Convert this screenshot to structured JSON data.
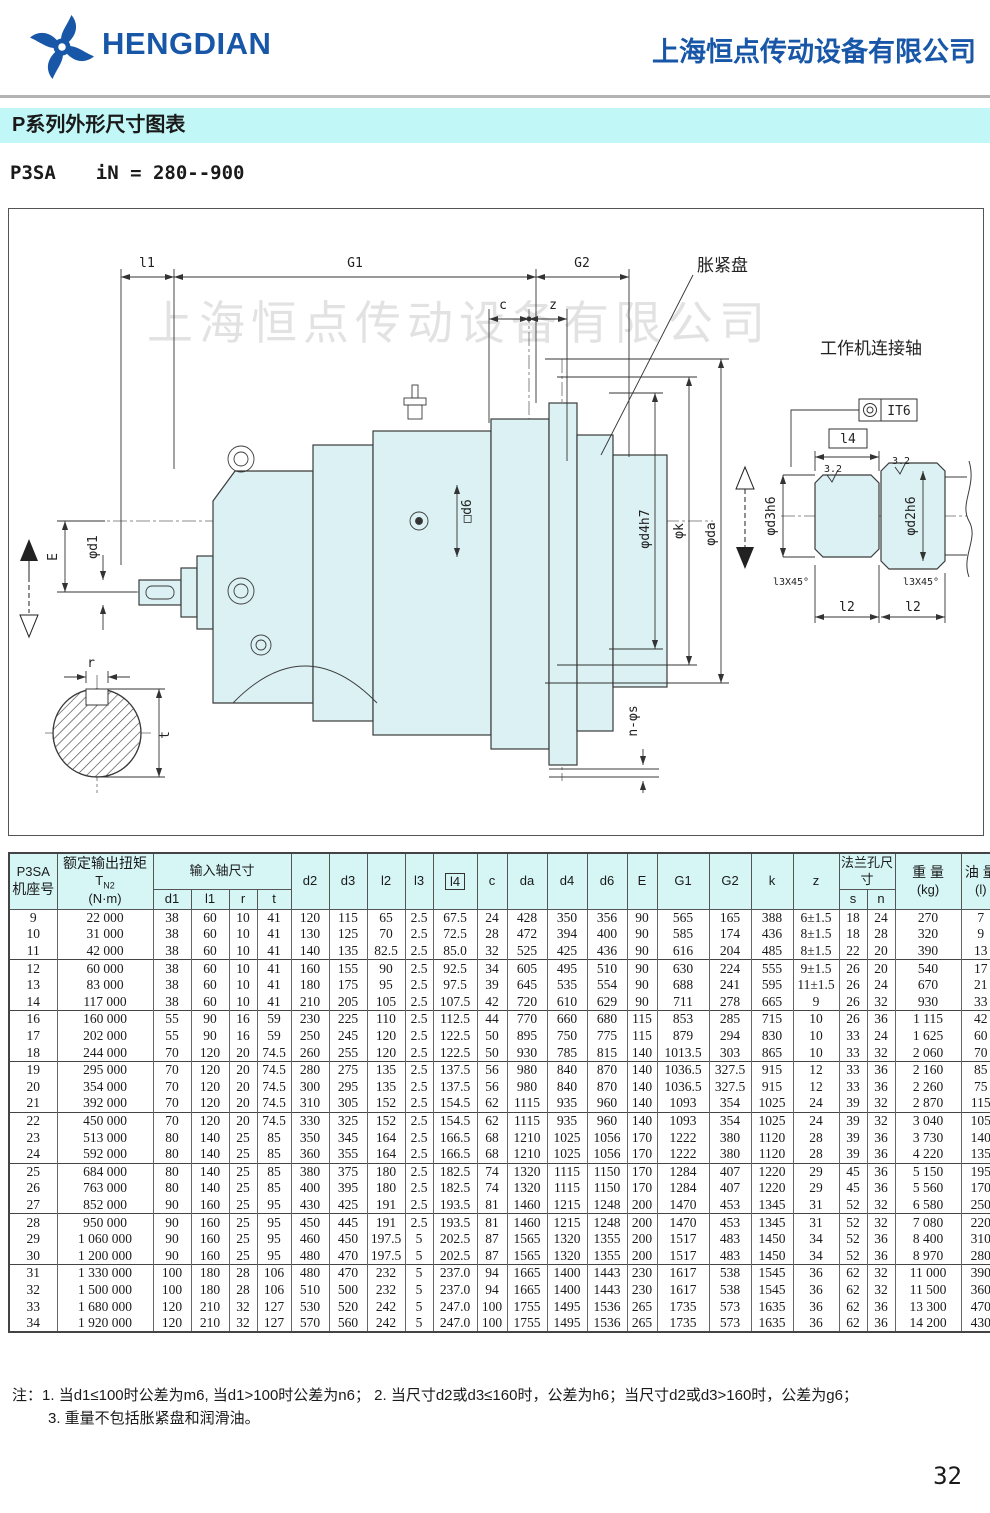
{
  "header": {
    "logo_text": "HENGDIAN",
    "company_name": "上海恒点传动设备有限公司"
  },
  "title_bar": "P系列外形尺寸图表",
  "subtitle": {
    "model": "P3SA",
    "ratio": "iN = 280--900"
  },
  "drawing": {
    "watermark": "上海恒点传动设备有限公司",
    "labels": {
      "l1": "l1",
      "g1": "G1",
      "g2": "G2",
      "c": "c",
      "z": "z",
      "shrink_disk": "胀紧盘",
      "work_shaft": "工作机连接轴",
      "it6": "IT6",
      "l4": "l4",
      "rough_left": "3.2",
      "rough_right": "3.2",
      "d3": "φd3h6",
      "d2": "φd2h6",
      "d4": "φd4h7",
      "k": "φk",
      "da": "φda",
      "d6": "□d6",
      "d1": "φd1",
      "e": "E",
      "chamfer_left": "l3X45°",
      "chamfer_right": "l3X45°",
      "l2_left": "l2",
      "l2_right": "l2",
      "ns": "n-φs",
      "r": "r",
      "t": "t"
    }
  },
  "table": {
    "headers": {
      "col1_line1": "P3SA",
      "col1_line2": "机座号",
      "torque_line1": "额定输出扭矩",
      "torque_t": "T",
      "torque_sub": "N2",
      "torque_unit": "(N·m)",
      "input_group": "输入轴尺寸",
      "sub": [
        "d1",
        "l1",
        "r",
        "t"
      ],
      "singles": [
        "d2",
        "d3",
        "l2",
        "l3",
        "l4",
        "c",
        "da",
        "d4",
        "d6",
        "E",
        "G1",
        "G2",
        "k",
        "z"
      ],
      "flange_group": "法兰孔尺寸",
      "flange_sub": [
        "s",
        "n"
      ],
      "weight_line1": "重 量",
      "weight_line2": "(kg)",
      "oil_line1": "油 量",
      "oil_line2": "(l)"
    },
    "groups": [
      [
        [
          "9",
          "22 000",
          "38",
          "60",
          "10",
          "41",
          "120",
          "115",
          "65",
          "2.5",
          "67.5",
          "24",
          "428",
          "350",
          "356",
          "90",
          "565",
          "165",
          "388",
          "6±1.5",
          "18",
          "24",
          "270",
          "7"
        ],
        [
          "10",
          "31 000",
          "38",
          "60",
          "10",
          "41",
          "130",
          "125",
          "70",
          "2.5",
          "72.5",
          "28",
          "472",
          "394",
          "400",
          "90",
          "585",
          "174",
          "436",
          "8±1.5",
          "18",
          "28",
          "320",
          "9"
        ],
        [
          "11",
          "42 000",
          "38",
          "60",
          "10",
          "41",
          "140",
          "135",
          "82.5",
          "2.5",
          "85.0",
          "32",
          "525",
          "425",
          "436",
          "90",
          "616",
          "204",
          "485",
          "8±1.5",
          "22",
          "20",
          "390",
          "13"
        ]
      ],
      [
        [
          "12",
          "60 000",
          "38",
          "60",
          "10",
          "41",
          "160",
          "155",
          "90",
          "2.5",
          "92.5",
          "34",
          "605",
          "495",
          "510",
          "90",
          "630",
          "224",
          "555",
          "9±1.5",
          "26",
          "20",
          "540",
          "17"
        ],
        [
          "13",
          "83 000",
          "38",
          "60",
          "10",
          "41",
          "180",
          "175",
          "95",
          "2.5",
          "97.5",
          "39",
          "645",
          "535",
          "554",
          "90",
          "688",
          "241",
          "595",
          "11±1.5",
          "26",
          "24",
          "670",
          "21"
        ],
        [
          "14",
          "117 000",
          "38",
          "60",
          "10",
          "41",
          "210",
          "205",
          "105",
          "2.5",
          "107.5",
          "42",
          "720",
          "610",
          "629",
          "90",
          "711",
          "278",
          "665",
          "9",
          "26",
          "32",
          "930",
          "33"
        ]
      ],
      [
        [
          "16",
          "160 000",
          "55",
          "90",
          "16",
          "59",
          "230",
          "225",
          "110",
          "2.5",
          "112.5",
          "44",
          "770",
          "660",
          "680",
          "115",
          "853",
          "285",
          "715",
          "10",
          "26",
          "36",
          "1 115",
          "42"
        ],
        [
          "17",
          "202 000",
          "55",
          "90",
          "16",
          "59",
          "250",
          "245",
          "120",
          "2.5",
          "122.5",
          "50",
          "895",
          "750",
          "775",
          "115",
          "879",
          "294",
          "830",
          "10",
          "33",
          "24",
          "1 625",
          "60"
        ],
        [
          "18",
          "244 000",
          "70",
          "120",
          "20",
          "74.5",
          "260",
          "255",
          "120",
          "2.5",
          "122.5",
          "50",
          "930",
          "785",
          "815",
          "140",
          "1013.5",
          "303",
          "865",
          "10",
          "33",
          "32",
          "2 060",
          "70"
        ]
      ],
      [
        [
          "19",
          "295 000",
          "70",
          "120",
          "20",
          "74.5",
          "280",
          "275",
          "135",
          "2.5",
          "137.5",
          "56",
          "980",
          "840",
          "870",
          "140",
          "1036.5",
          "327.5",
          "915",
          "12",
          "33",
          "36",
          "2 160",
          "85"
        ],
        [
          "20",
          "354 000",
          "70",
          "120",
          "20",
          "74.5",
          "300",
          "295",
          "135",
          "2.5",
          "137.5",
          "56",
          "980",
          "840",
          "870",
          "140",
          "1036.5",
          "327.5",
          "915",
          "12",
          "33",
          "36",
          "2 260",
          "75"
        ],
        [
          "21",
          "392 000",
          "70",
          "120",
          "20",
          "74.5",
          "310",
          "305",
          "152",
          "2.5",
          "154.5",
          "62",
          "1115",
          "935",
          "960",
          "140",
          "1093",
          "354",
          "1025",
          "24",
          "39",
          "32",
          "2 870",
          "115"
        ]
      ],
      [
        [
          "22",
          "450 000",
          "70",
          "120",
          "20",
          "74.5",
          "330",
          "325",
          "152",
          "2.5",
          "154.5",
          "62",
          "1115",
          "935",
          "960",
          "140",
          "1093",
          "354",
          "1025",
          "24",
          "39",
          "32",
          "3 040",
          "105"
        ],
        [
          "23",
          "513 000",
          "80",
          "140",
          "25",
          "85",
          "350",
          "345",
          "164",
          "2.5",
          "166.5",
          "68",
          "1210",
          "1025",
          "1056",
          "170",
          "1222",
          "380",
          "1120",
          "28",
          "39",
          "36",
          "3 730",
          "140"
        ],
        [
          "24",
          "592 000",
          "80",
          "140",
          "25",
          "85",
          "360",
          "355",
          "164",
          "2.5",
          "166.5",
          "68",
          "1210",
          "1025",
          "1056",
          "170",
          "1222",
          "380",
          "1120",
          "28",
          "39",
          "36",
          "4 220",
          "135"
        ]
      ],
      [
        [
          "25",
          "684 000",
          "80",
          "140",
          "25",
          "85",
          "380",
          "375",
          "180",
          "2.5",
          "182.5",
          "74",
          "1320",
          "1115",
          "1150",
          "170",
          "1284",
          "407",
          "1220",
          "29",
          "45",
          "36",
          "5 150",
          "195"
        ],
        [
          "26",
          "763 000",
          "80",
          "140",
          "25",
          "85",
          "400",
          "395",
          "180",
          "2.5",
          "182.5",
          "74",
          "1320",
          "1115",
          "1150",
          "170",
          "1284",
          "407",
          "1220",
          "29",
          "45",
          "36",
          "5 560",
          "170"
        ],
        [
          "27",
          "852 000",
          "90",
          "160",
          "25",
          "95",
          "430",
          "425",
          "191",
          "2.5",
          "193.5",
          "81",
          "1460",
          "1215",
          "1248",
          "200",
          "1470",
          "453",
          "1345",
          "31",
          "52",
          "32",
          "6 580",
          "250"
        ]
      ],
      [
        [
          "28",
          "950 000",
          "90",
          "160",
          "25",
          "95",
          "450",
          "445",
          "191",
          "2.5",
          "193.5",
          "81",
          "1460",
          "1215",
          "1248",
          "200",
          "1470",
          "453",
          "1345",
          "31",
          "52",
          "32",
          "7 080",
          "220"
        ],
        [
          "29",
          "1 060 000",
          "90",
          "160",
          "25",
          "95",
          "460",
          "450",
          "197.5",
          "5",
          "202.5",
          "87",
          "1565",
          "1320",
          "1355",
          "200",
          "1517",
          "483",
          "1450",
          "34",
          "52",
          "36",
          "8 400",
          "310"
        ],
        [
          "30",
          "1 200 000",
          "90",
          "160",
          "25",
          "95",
          "480",
          "470",
          "197.5",
          "5",
          "202.5",
          "87",
          "1565",
          "1320",
          "1355",
          "200",
          "1517",
          "483",
          "1450",
          "34",
          "52",
          "36",
          "8 970",
          "280"
        ]
      ],
      [
        [
          "31",
          "1 330 000",
          "100",
          "180",
          "28",
          "106",
          "480",
          "470",
          "232",
          "5",
          "237.0",
          "94",
          "1665",
          "1400",
          "1443",
          "230",
          "1617",
          "538",
          "1545",
          "36",
          "62",
          "32",
          "11 000",
          "390"
        ],
        [
          "32",
          "1 500 000",
          "100",
          "180",
          "28",
          "106",
          "510",
          "500",
          "232",
          "5",
          "237.0",
          "94",
          "1665",
          "1400",
          "1443",
          "230",
          "1617",
          "538",
          "1545",
          "36",
          "62",
          "32",
          "11 500",
          "360"
        ],
        [
          "33",
          "1 680 000",
          "120",
          "210",
          "32",
          "127",
          "530",
          "520",
          "242",
          "5",
          "247.0",
          "100",
          "1755",
          "1495",
          "1536",
          "265",
          "1735",
          "573",
          "1635",
          "36",
          "62",
          "36",
          "13 300",
          "470"
        ],
        [
          "34",
          "1 920 000",
          "120",
          "210",
          "32",
          "127",
          "570",
          "560",
          "242",
          "5",
          "247.0",
          "100",
          "1755",
          "1495",
          "1536",
          "265",
          "1735",
          "573",
          "1635",
          "36",
          "62",
          "36",
          "14 200",
          "430"
        ]
      ]
    ]
  },
  "notes": {
    "prefix": "注：",
    "item1": "1. 当d1≤100时公差为m6, 当d1>100时公差为n6；",
    "item2": "2. 当尺寸d2或d3≤160时，公差为h6；当尺寸d2或d3>160时，公差为g6；",
    "item3": "3. 重量不包括胀紧盘和润滑油。"
  },
  "page_number": "32"
}
